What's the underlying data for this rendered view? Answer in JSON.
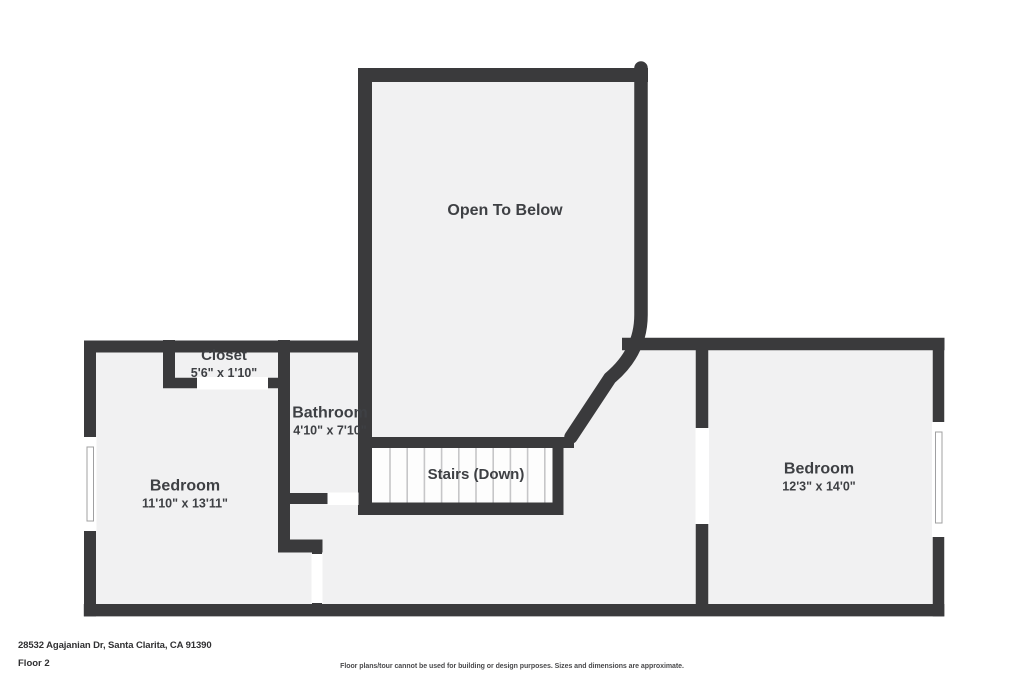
{
  "page": {
    "background": "#ffffff"
  },
  "plan": {
    "wall_color": "#3a3a3c",
    "room_fill": "#f1f1f2",
    "stairs_fill": "#fdfdfd",
    "text_color": "#3e4044",
    "rooms": {
      "open_to_below": {
        "label": "Open To Below"
      },
      "closet": {
        "label": "Closet",
        "dimensions": "5'6\" x 1'10\""
      },
      "bathroom": {
        "label": "Bathroom",
        "dimensions": "4'10\" x 7'10\""
      },
      "stairs": {
        "label": "Stairs (Down)"
      },
      "bedroom_left": {
        "label": "Bedroom",
        "dimensions": "11'10\" x 13'11\""
      },
      "bedroom_right": {
        "label": "Bedroom",
        "dimensions": "12'3\" x 14'0\""
      }
    }
  },
  "footer": {
    "address": "28532 Agajanian Dr, Santa Clarita, CA 91390",
    "floor_label": "Floor 2",
    "disclaimer": "Floor plans/tour cannot be used for building or design purposes. Sizes and dimensions are approximate."
  }
}
